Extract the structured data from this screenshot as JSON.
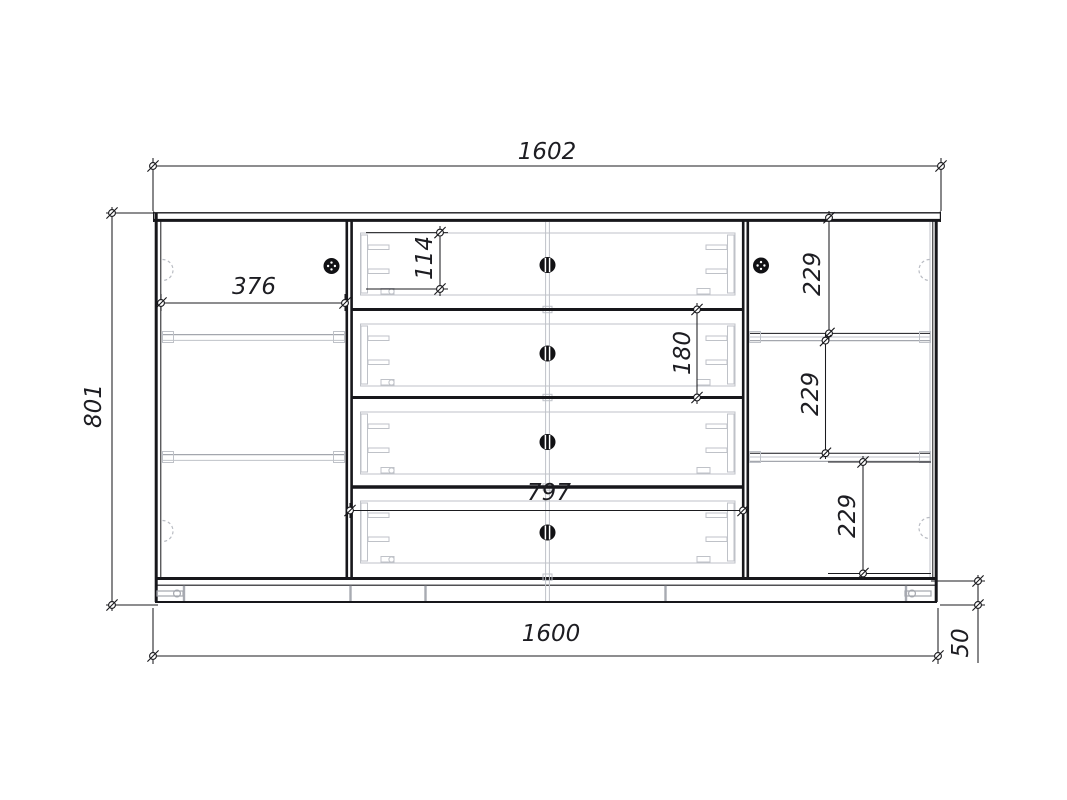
{
  "drawing": {
    "type": "furniture-front-view-dimension-drawing",
    "dimensions": {
      "top_width": "1602",
      "height": "801",
      "left_section_width": "376",
      "top_drawer_height": "114",
      "second_drawer_pitch": "180",
      "right_gap_top": "229",
      "right_gap_middle": "229",
      "right_gap_bottom": "229",
      "drawer_section_width": "797",
      "bottom_width": "1600",
      "plinth_height": "50"
    },
    "colors": {
      "line": "#17171b",
      "light_detail": "#bfc2c8",
      "medium_detail": "#a4a7ae",
      "background": "#ffffff"
    }
  }
}
